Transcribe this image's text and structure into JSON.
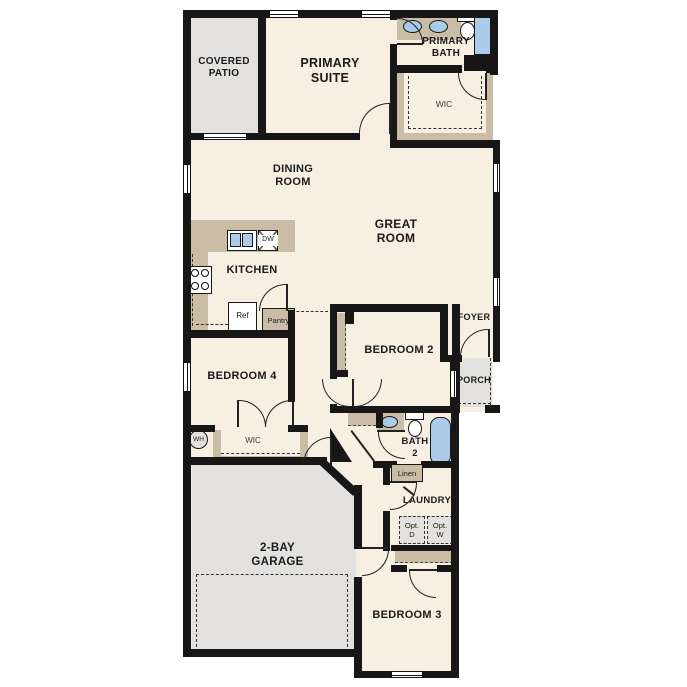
{
  "labels": {
    "covered_patio": "COVERED\nPATIO",
    "primary_suite": "PRIMARY\nSUITE",
    "primary_bath": "PRIMARY\nBATH",
    "wic_primary": "WIC",
    "dining_room": "DINING\nROOM",
    "great_room": "GREAT\nROOM",
    "kitchen": "KITCHEN",
    "dw": "DW",
    "ref": "Ref",
    "pantry": "Pantry",
    "bedroom2": "BEDROOM 2",
    "foyer": "FOYER",
    "porch": "PORCH",
    "bedroom4": "BEDROOM 4",
    "wic_bed4": "WIC",
    "wh": "WH",
    "bath2": "BATH\n2",
    "linen": "Linen",
    "laundry": "LAUNDRY",
    "opt_d": "Opt.\nD",
    "opt_w": "Opt.\nW",
    "garage": "2-BAY\nGARAGE",
    "bedroom3": "BEDROOM 3"
  },
  "colors": {
    "floor": "#f6efe2",
    "hardscape": "#e2e1df",
    "cabinet_tan": "#c9bda6",
    "fixture_blue": "#abcbe9",
    "wall": "#171717"
  }
}
